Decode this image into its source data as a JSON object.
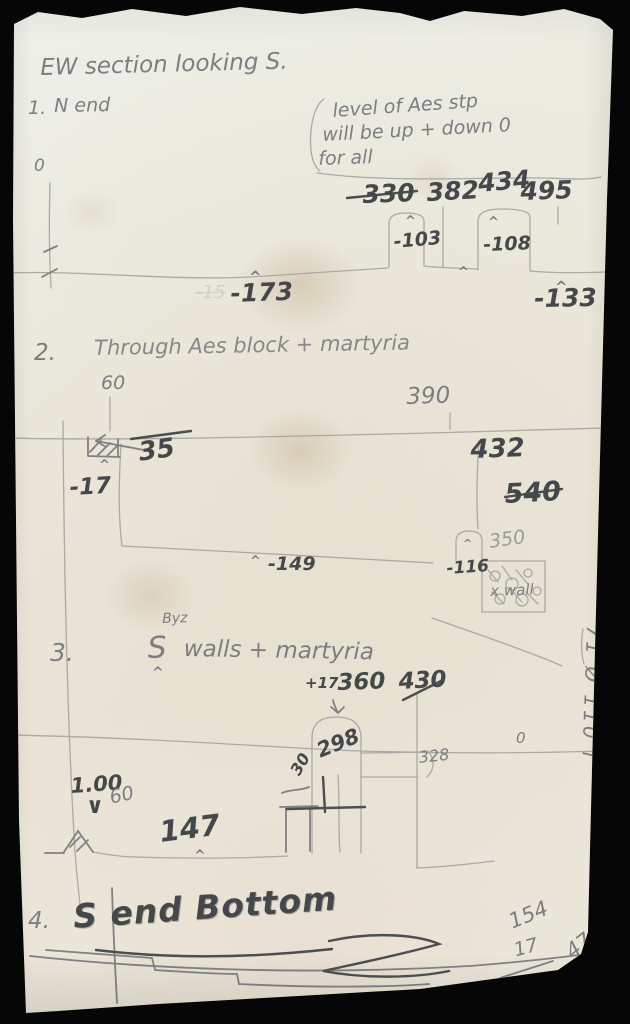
{
  "title": "EW section looking S.",
  "glyphs": {
    "caret": "^",
    "arrow_down": "∨"
  },
  "s1": {
    "number": "1.",
    "label": "N end",
    "datum": "0",
    "note": {
      "l1": "level of Aes stp",
      "l2": "will be up + down 0",
      "l3": "for all"
    },
    "tops": {
      "a": "330",
      "b": "382",
      "c": "434",
      "d": "495"
    },
    "depths": {
      "a": "-103",
      "b": "-108",
      "c": "-173",
      "d": "-133"
    },
    "erased": "-15"
  },
  "s2": {
    "number": "2.",
    "label": "Through Aes block + martyria",
    "v60": "60",
    "v390": "390",
    "v35": "35",
    "d17": "-17",
    "d149": "-149",
    "v432": "432",
    "v540": "540",
    "v350": "350",
    "d116": "-116",
    "wall": "x wall"
  },
  "s3": {
    "number": "3.",
    "s": "S",
    "super": "Byz",
    "rest": "walls + martyria",
    "p17": "+17",
    "v360": "360",
    "v430": "430",
    "v100": "1.00",
    "v60": "60",
    "v147": "147",
    "v30": "30",
    "v298": "298",
    "v328": "328",
    "zero": "0"
  },
  "s4": {
    "number": "4.",
    "label": "S end Bottom",
    "v154": "154",
    "v17": "17",
    "v47": "47"
  },
  "margin_note": "71 Ø 110 f"
}
